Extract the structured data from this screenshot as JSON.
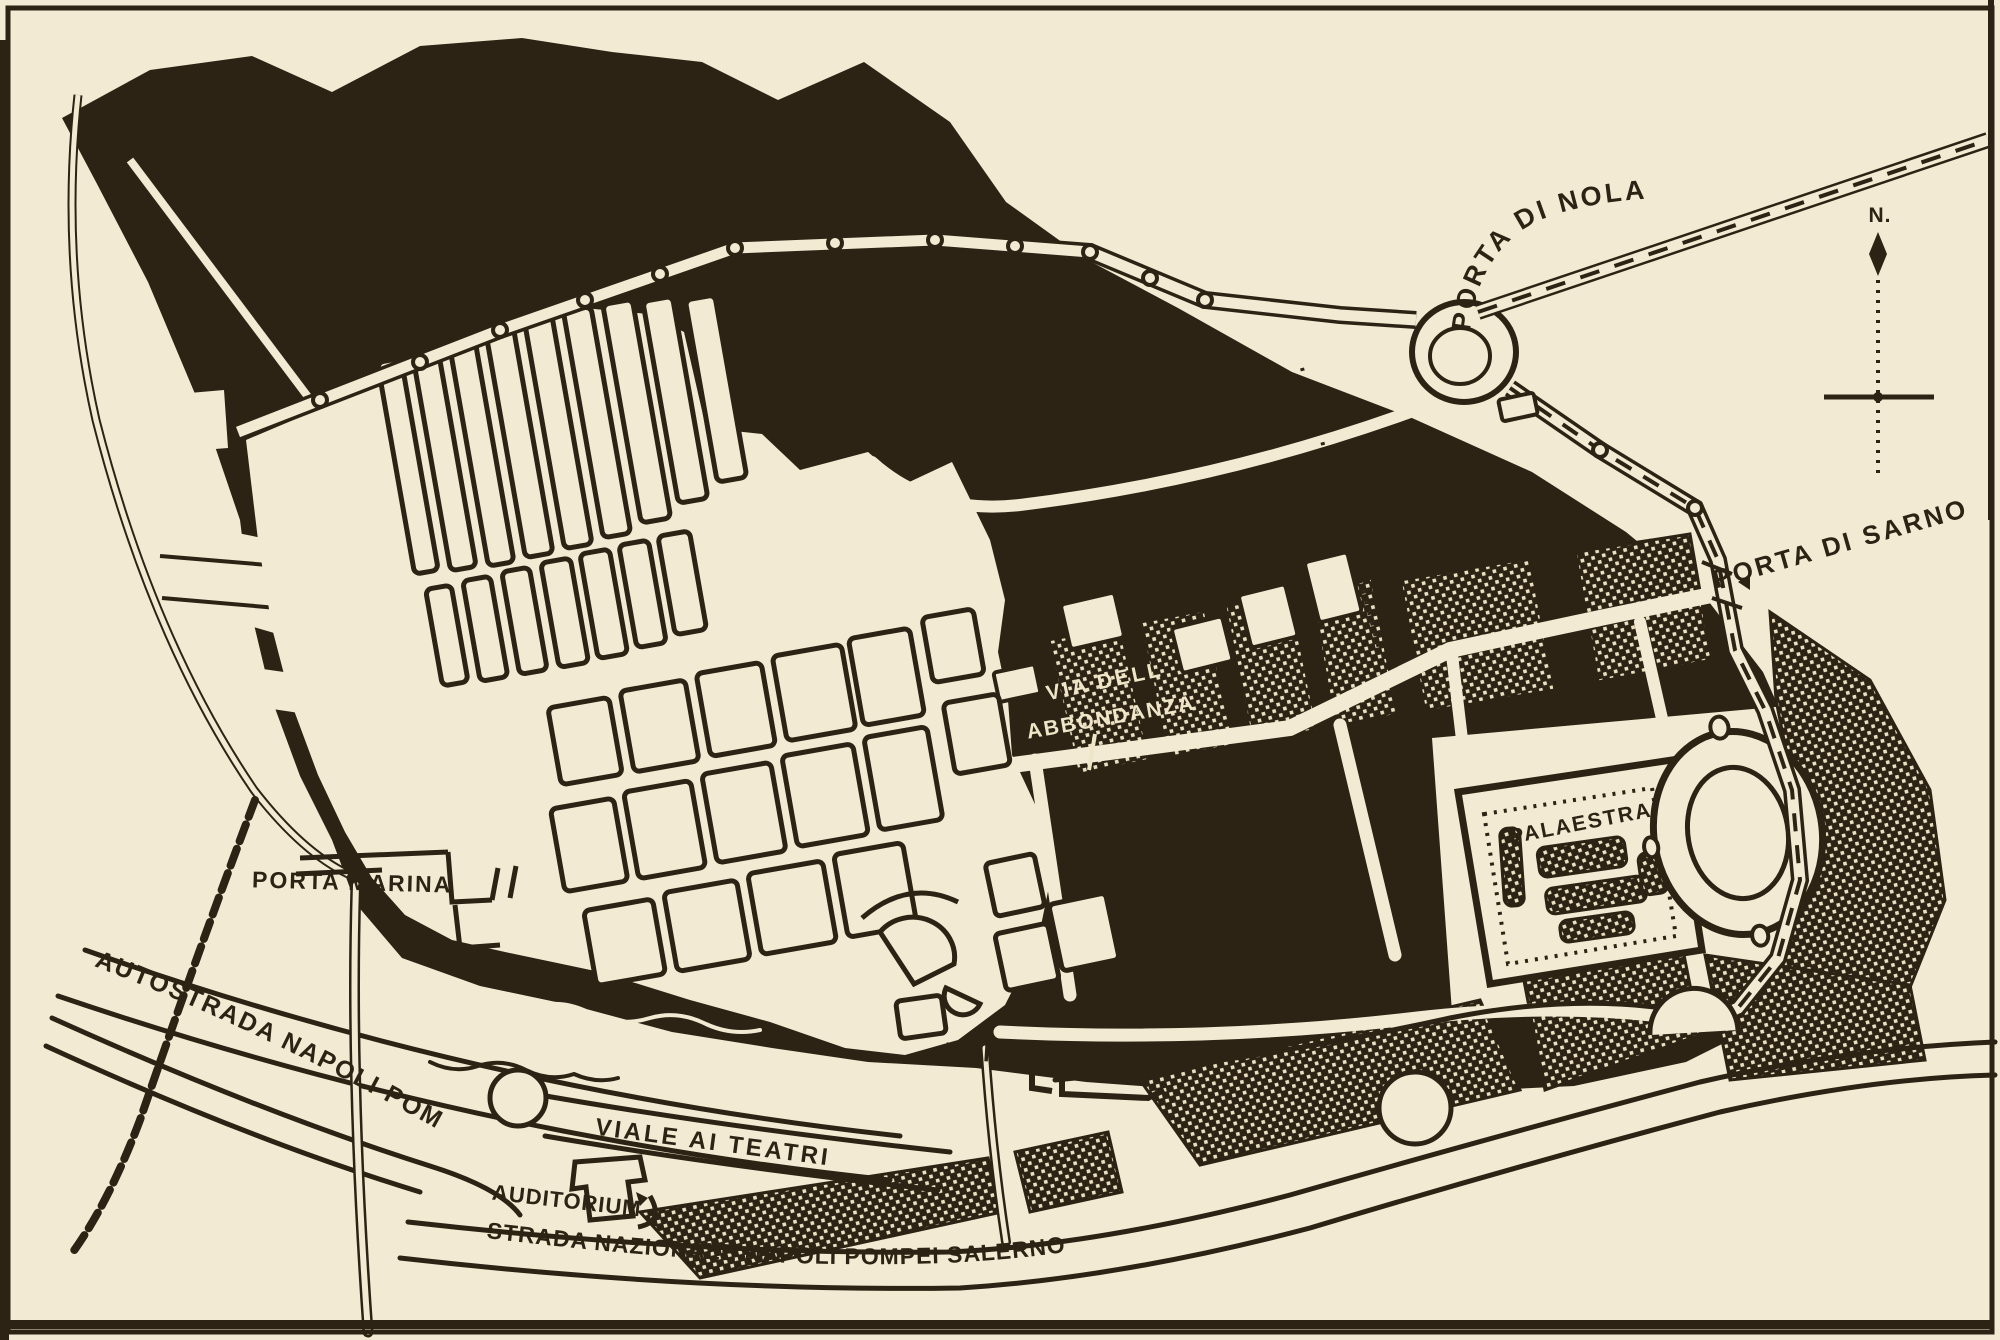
{
  "map": {
    "kind": "printed-excavation-plan",
    "paper_color": "#f2ead2",
    "ink_color": "#2d2315",
    "hatch_dot_color": "#ece0c2",
    "labels": {
      "porta_di_nola": "PORTA DI NOLA",
      "porta_di_sarno": "PORTA DI SARNO",
      "via_dell_abbondanza_line1": "VIA DELL",
      "via_dell_abbondanza_line2": "ABBONDANZA",
      "palaestra": "PALAESTRA",
      "porta_marina": "PORTA MARINA",
      "autostrada": "AUTOSTRADA NAPOLI POMPEI",
      "porta_di_stabia": "PORTA DI STABIA",
      "viale_ai_teatri": "VIALE AI TEATRI",
      "auditorium": "AUDITORIUM",
      "strada_nazionale": "STRADA NAZIONALE NAPOLI POMPEI SALERNO",
      "north": "N."
    }
  }
}
